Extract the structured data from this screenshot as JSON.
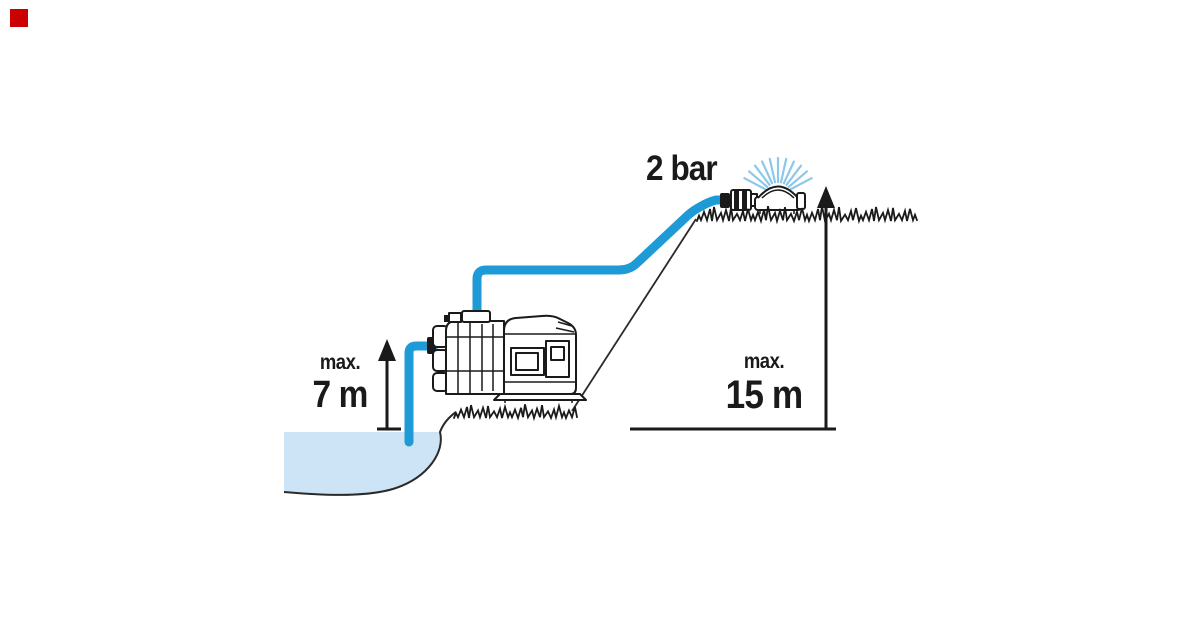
{
  "title": "Garden pump suction and delivery height diagram",
  "marker": {
    "color": "#cc0000"
  },
  "labels": {
    "pressure": "2 bar",
    "suction_height": {
      "prefix": "max.",
      "value": "7 m"
    },
    "delivery_height": {
      "prefix": "max.",
      "value": "15 m"
    }
  },
  "icons": {
    "pump": "pump-illustration",
    "sprinkler": "sprinkler-icon",
    "water": "water-pond",
    "suction_arrow": "suction-height-arrow",
    "delivery_arrow": "delivery-height-arrow"
  },
  "colors": {
    "hose": "#1e9ad6",
    "spray": "#8cc8ea",
    "water": "#cde4f6",
    "outline": "#1a1a1a",
    "marker": "#cc0000"
  }
}
